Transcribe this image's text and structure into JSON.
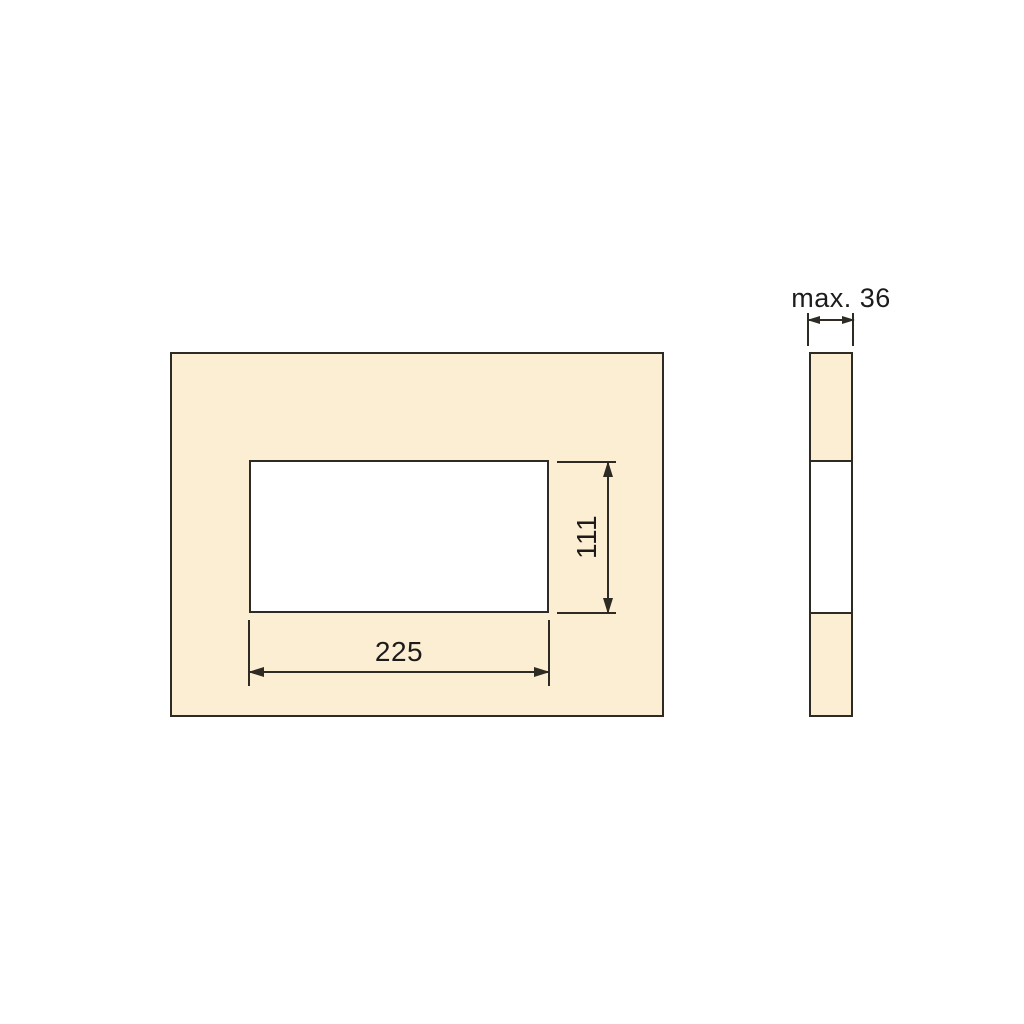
{
  "diagram": {
    "kind": "technical-dimension-drawing",
    "front_view": {
      "cutout_width_label": "225",
      "cutout_height_label": "111"
    },
    "side_view": {
      "thickness_label": "max. 36"
    },
    "colors": {
      "panel-fill": "#fceed3",
      "cutout-fill": "#ffffff",
      "line": "#2e2a24",
      "text": "#1d1c1a",
      "background": "#ffffff"
    }
  }
}
